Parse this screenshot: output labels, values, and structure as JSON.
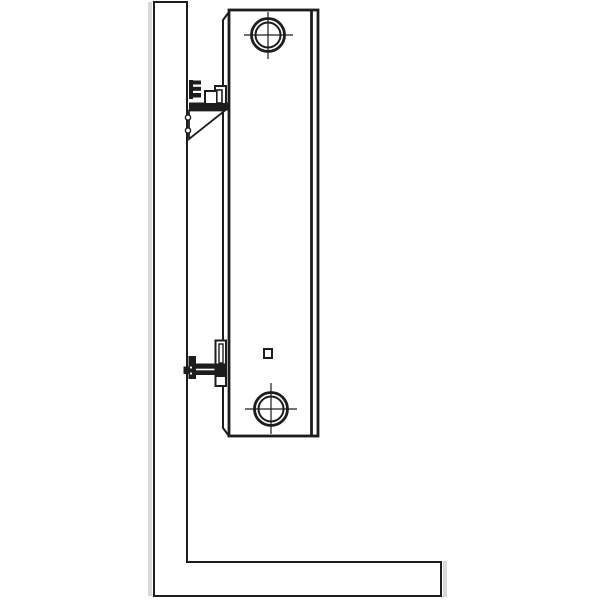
{
  "diagram": {
    "description": "Technical side-view line drawing of a wall-mounted panel radiator: hatched wall section at left, hatched floor section at bottom, radiator panel hung on an upper toothed adjustment bracket and a lower support bracket, with circular pipe-connection ports (crosshair center marks) at top and bottom and a small square vent marker",
    "type": "technical-line-drawing",
    "colors": {
      "background": "#ffffff",
      "line": "#1d1d1d",
      "hatch": "#3d3d3d",
      "shadow": "#d9d9d9",
      "fill": "#ffffff"
    },
    "elements": [
      "wall-section-hatched",
      "floor-section-hatched",
      "radiator-body",
      "radiator-front-panel-line",
      "radiator-back-flange",
      "top-connection-port",
      "bottom-connection-port",
      "vent-square-marker",
      "upper-bracket-toothed-rail",
      "upper-bracket-arm",
      "upper-bracket-hook",
      "upper-bracket-gusset",
      "lower-bracket-wall-plate",
      "lower-bracket-screw",
      "lower-bracket-arm",
      "lower-bracket-clip"
    ]
  }
}
